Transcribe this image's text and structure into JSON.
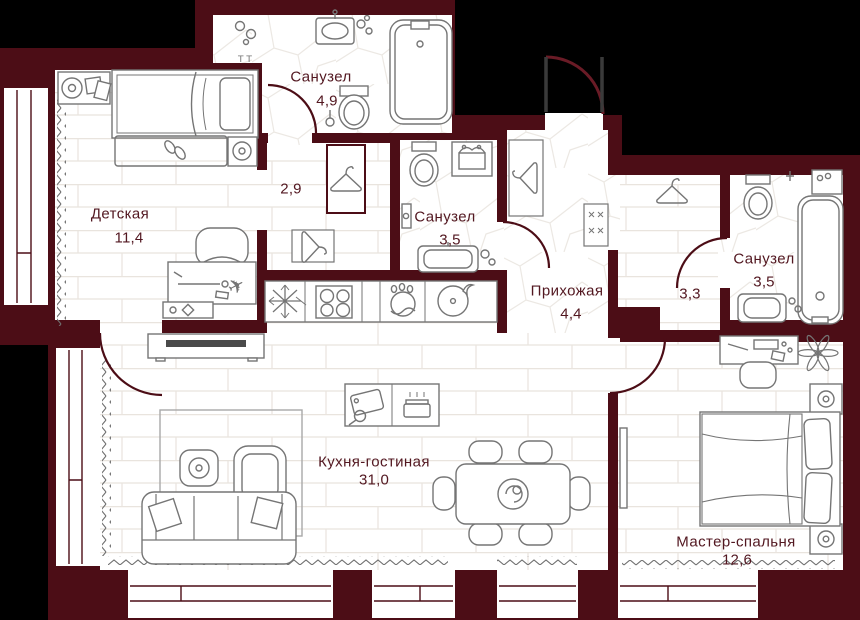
{
  "rooms": [
    {
      "name": "Санузел",
      "area": "4,9"
    },
    {
      "name": "Детская",
      "area": "11,4"
    },
    {
      "name": "",
      "area": "2,9"
    },
    {
      "name": "Санузел",
      "area": "3,5"
    },
    {
      "name": "Прихожая",
      "area": "4,4"
    },
    {
      "name": "",
      "area": "3,3"
    },
    {
      "name": "Санузел",
      "area": "3,5"
    },
    {
      "name": "Кухня-гостиная",
      "area": "31,0"
    },
    {
      "name": "Мастер-спальня",
      "area": "12,6"
    }
  ],
  "icons": {
    "airplane": "✈",
    "towel_hooks": "Т Т"
  },
  "colors": {
    "wall": "#4c0d16",
    "outside": "#000000",
    "floor": "#ffffff",
    "label": "#521720",
    "furniture_line": "#757575"
  }
}
